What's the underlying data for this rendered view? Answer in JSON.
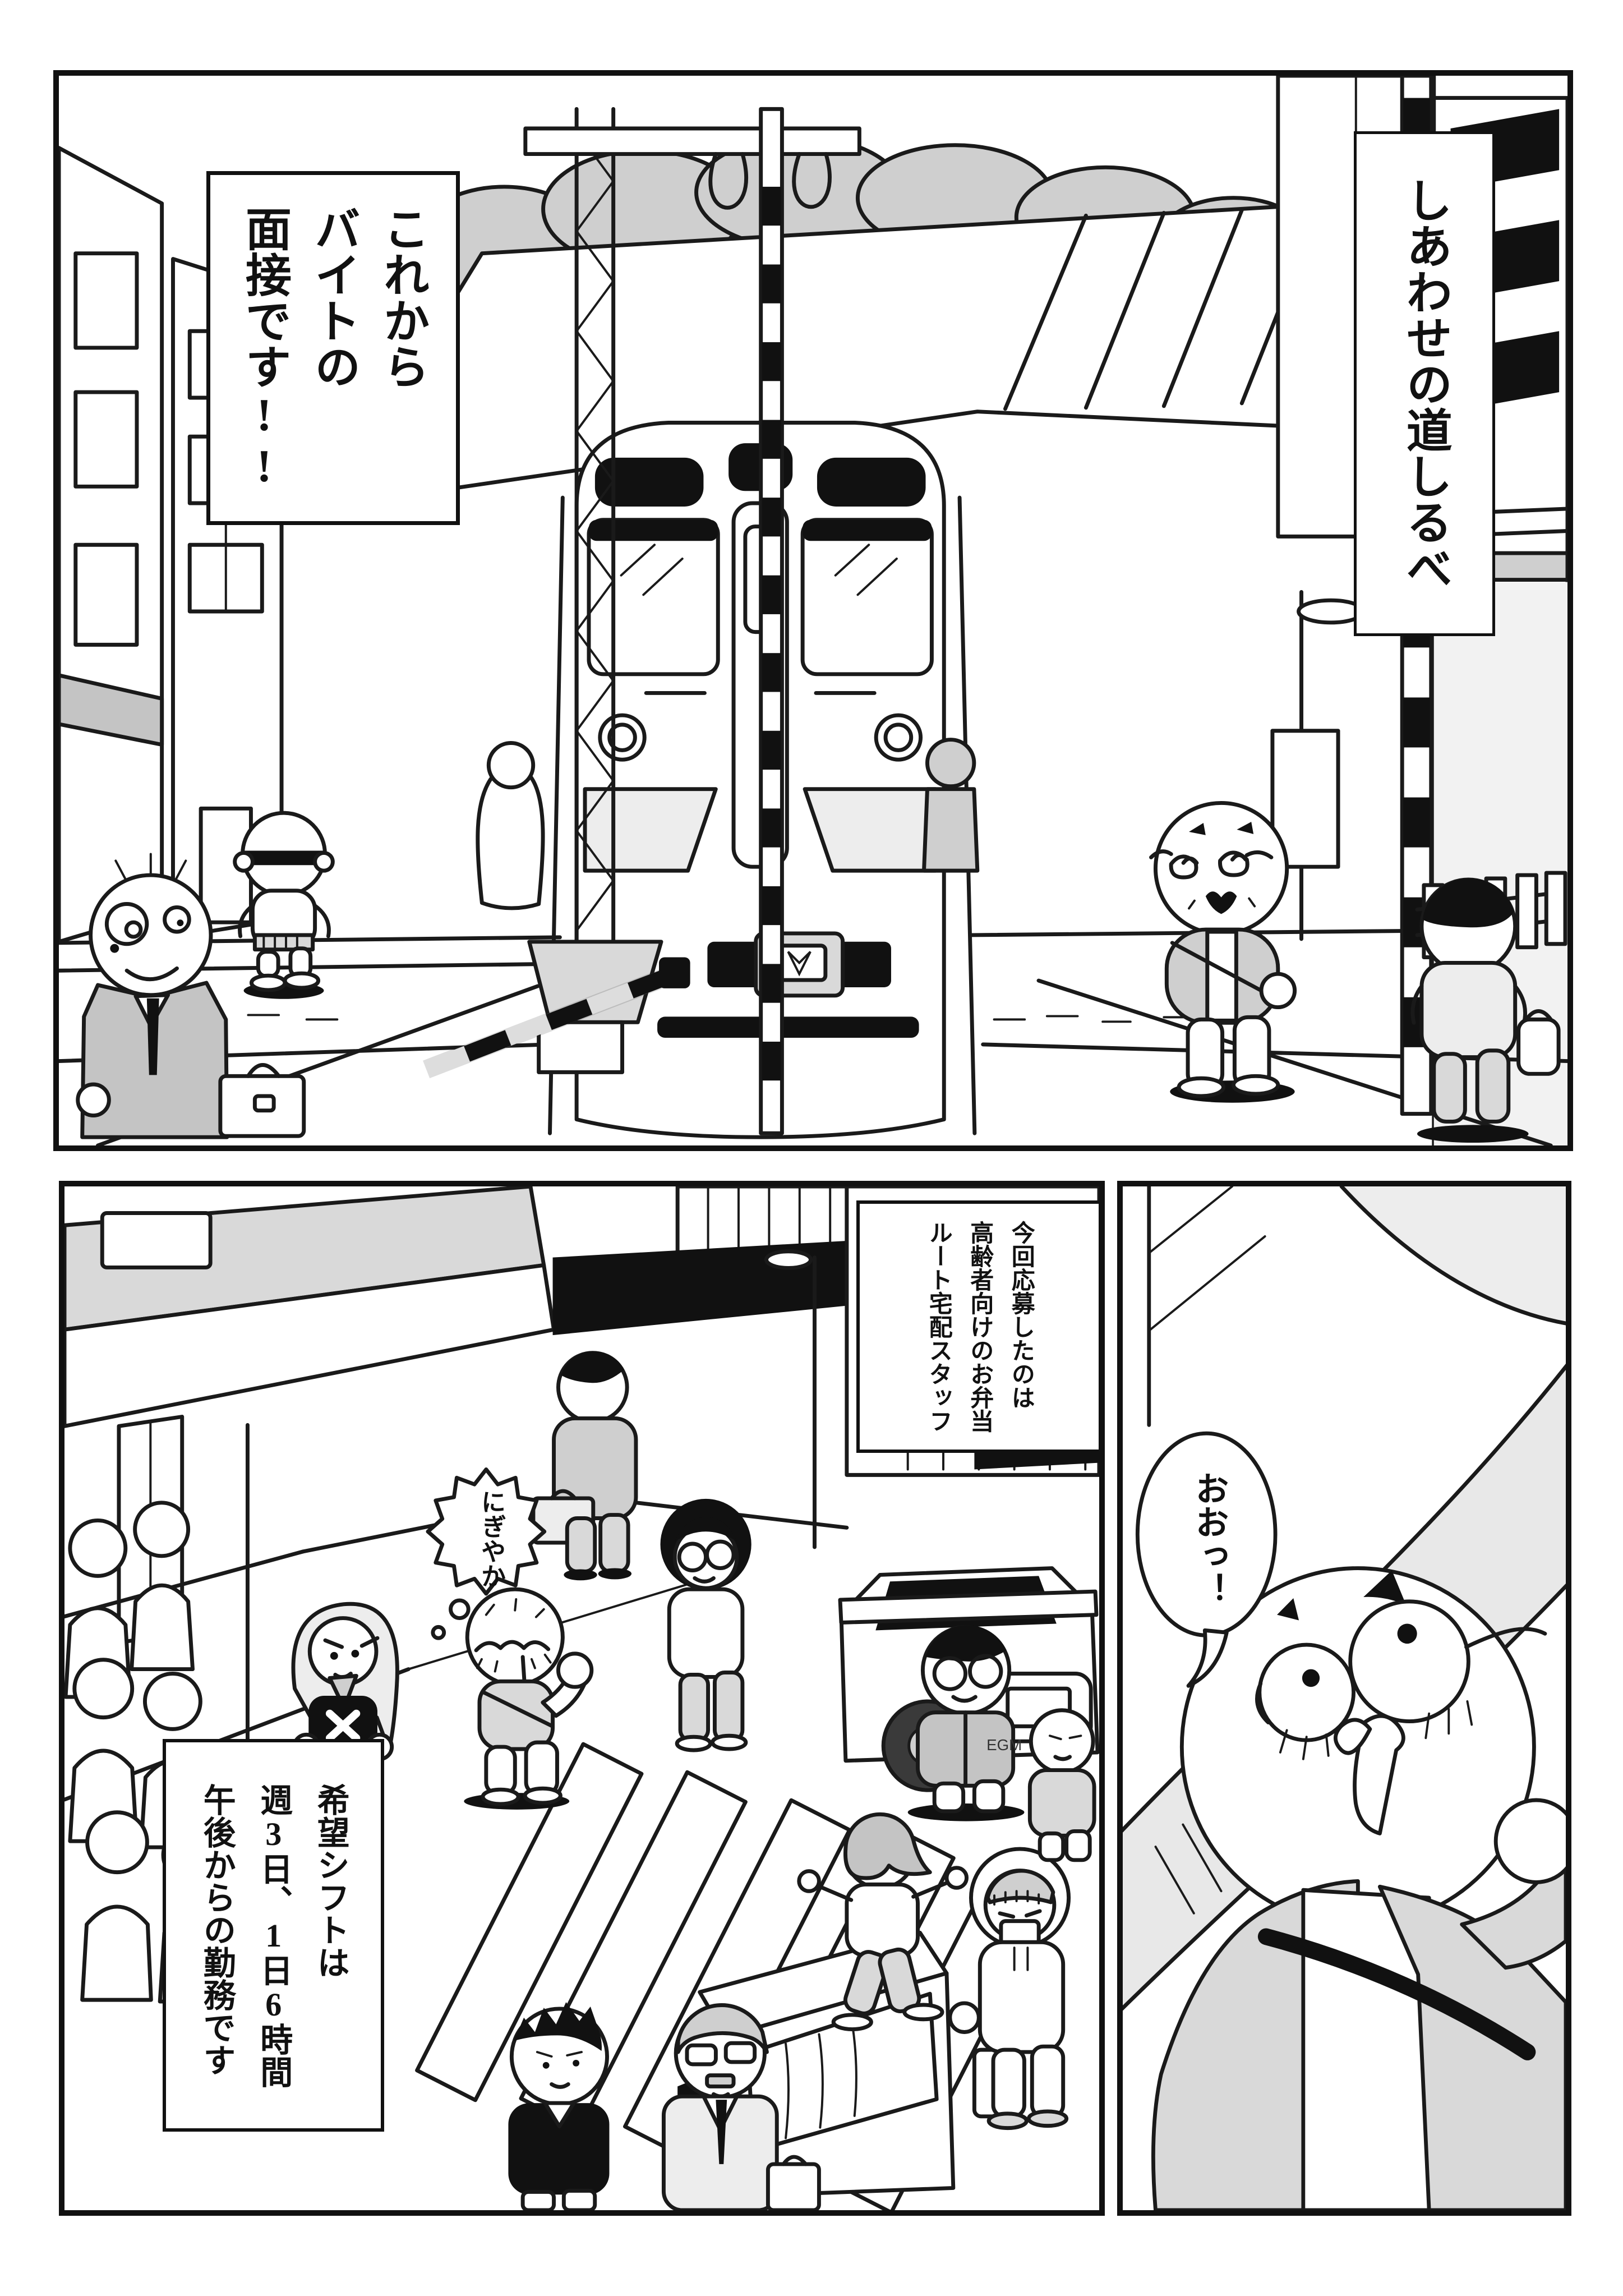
{
  "meta": {
    "type": "manga-page",
    "language": "ja",
    "panel_count": 3,
    "colors": {
      "paper": "#ffffff",
      "ink": "#1a1a1a",
      "black_fill": "#111111",
      "gray_light": "#ededed",
      "gray_mid": "#d9d9d9",
      "gray_tree": "#cfcfcf"
    }
  },
  "panel1": {
    "description": "railroad crossing with approaching train, city street",
    "balloon": "これから\nバイトの\n面接です!!",
    "title": "しあわせの道しるべ"
  },
  "panel2": {
    "description": "busy shopping street with crowd and crosswalk",
    "caption_right": "今回応募したのは\n高齢者向けのお弁当\nルート宅配スタッフ",
    "thought": "にぎやか",
    "caption_left": "希望シフトは\n週3日、1日6時間\n午後からの勤務です",
    "jacket_text": "EGM"
  },
  "panel3": {
    "description": "close-up of delighted elderly man under overpass",
    "balloon": "おおっ！"
  }
}
